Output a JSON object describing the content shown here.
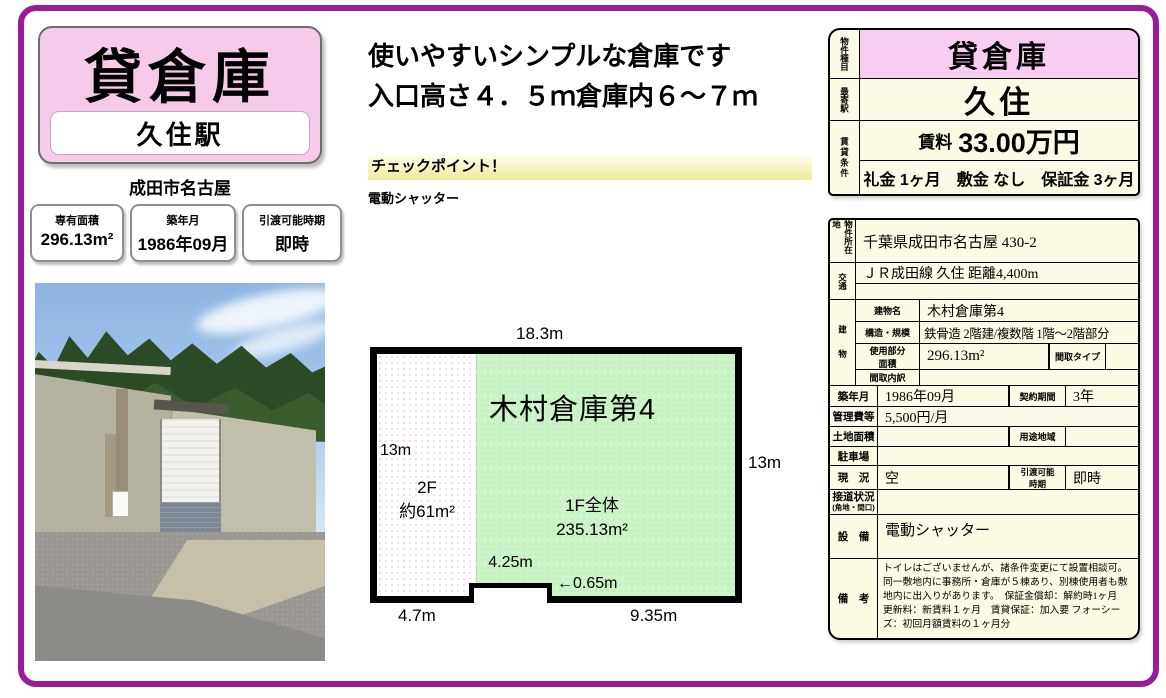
{
  "header": {
    "title": "貸倉庫",
    "station": "久住駅",
    "address": "成田市名古屋",
    "info_boxes": [
      {
        "label": "専有面積",
        "value": "296.13m²"
      },
      {
        "label": "築年月",
        "value": "1986年09月"
      },
      {
        "label": "引渡可能時期",
        "value": "即時"
      }
    ]
  },
  "tagline": {
    "line1": "使いやすいシンプルな倉庫です",
    "line2": "入口高さ４．５ｍ倉庫内６～７ｍ"
  },
  "checkpoint": {
    "heading": "チェックポイント！",
    "item": "電動シャッター"
  },
  "floor_plan": {
    "building_name": "木村倉庫第4",
    "second_floor_label": "2F",
    "second_floor_area": "約61m²",
    "first_floor_label": "1F全体",
    "first_floor_area": "235.13m²",
    "dim_top": "18.3m",
    "dim_left": "13m",
    "dim_right": "13m",
    "dim_notch_width": "4.25m",
    "dim_notch_depth": "←0.65m",
    "dim_bottom_left": "4.7m",
    "dim_bottom_right": "9.35m",
    "first_floor_color": "#cdf3c9"
  },
  "summary_table": {
    "property_type_label": "物件種目",
    "property_type": "貸倉庫",
    "station_label": "最寄駅",
    "station": "久住",
    "terms_label": "賃貸条件",
    "rent_label": "賃料",
    "rent": "33.00万円",
    "terms": "礼金 1ヶ月　敷金 なし　保証金 3ヶ月",
    "highlight_color": "#f7cef1"
  },
  "detail_table": {
    "location_label": "物件所在地",
    "location": "千葉県成田市名古屋 430-2",
    "access_label": "交通",
    "access_line1": "ＪＲ成田線 久住 距離4,400m",
    "access_line2": "",
    "building_label": "建物",
    "building_name_label": "建物名",
    "building_name": "木村倉庫第4",
    "structure_label": "構造・規模",
    "structure": "鉄骨造 2階建/複数階 1階～2階部分",
    "used_area_label": "使用部分面積",
    "used_area": "296.13m²",
    "layout_type_label": "間取タイプ",
    "layout_type": "",
    "layout_detail_label": "間取内訳",
    "layout_detail": "",
    "built_label": "築年月",
    "built": "1986年09月",
    "contract_label": "契約期間",
    "contract": "3年",
    "mgmt_fee_label": "管理費等",
    "mgmt_fee": "5,500円/月",
    "land_area_label": "土地面積",
    "land_area": "",
    "zoning_label": "用途地域",
    "zoning": "",
    "parking_label": "駐車場",
    "parking": "",
    "status_label": "現　況",
    "status": "空",
    "handover_label": "引渡可能時期",
    "handover": "即時",
    "road_label": "接道状況",
    "road_label2": "(角地・間口)",
    "road": "",
    "equipment_label": "設　備",
    "equipment": "電動シャッター",
    "remarks_label": "備　考",
    "remarks": "トイレはございませんが、諸条件変更にて設置相談可。同一敷地内に事務所・倉庫が５棟あり、別棟使用者も敷地内に出入りがあります。　保証金償却：解約時1ヶ月　更新料：新賃料１ヶ月　賃貸保証：加入要 フォーシーズ：初回月額賃料の１ヶ月分"
  },
  "colors": {
    "frame": "#9b1c9b",
    "title_pink": "#f5cbe9",
    "table_cream": "#fbfae4"
  }
}
